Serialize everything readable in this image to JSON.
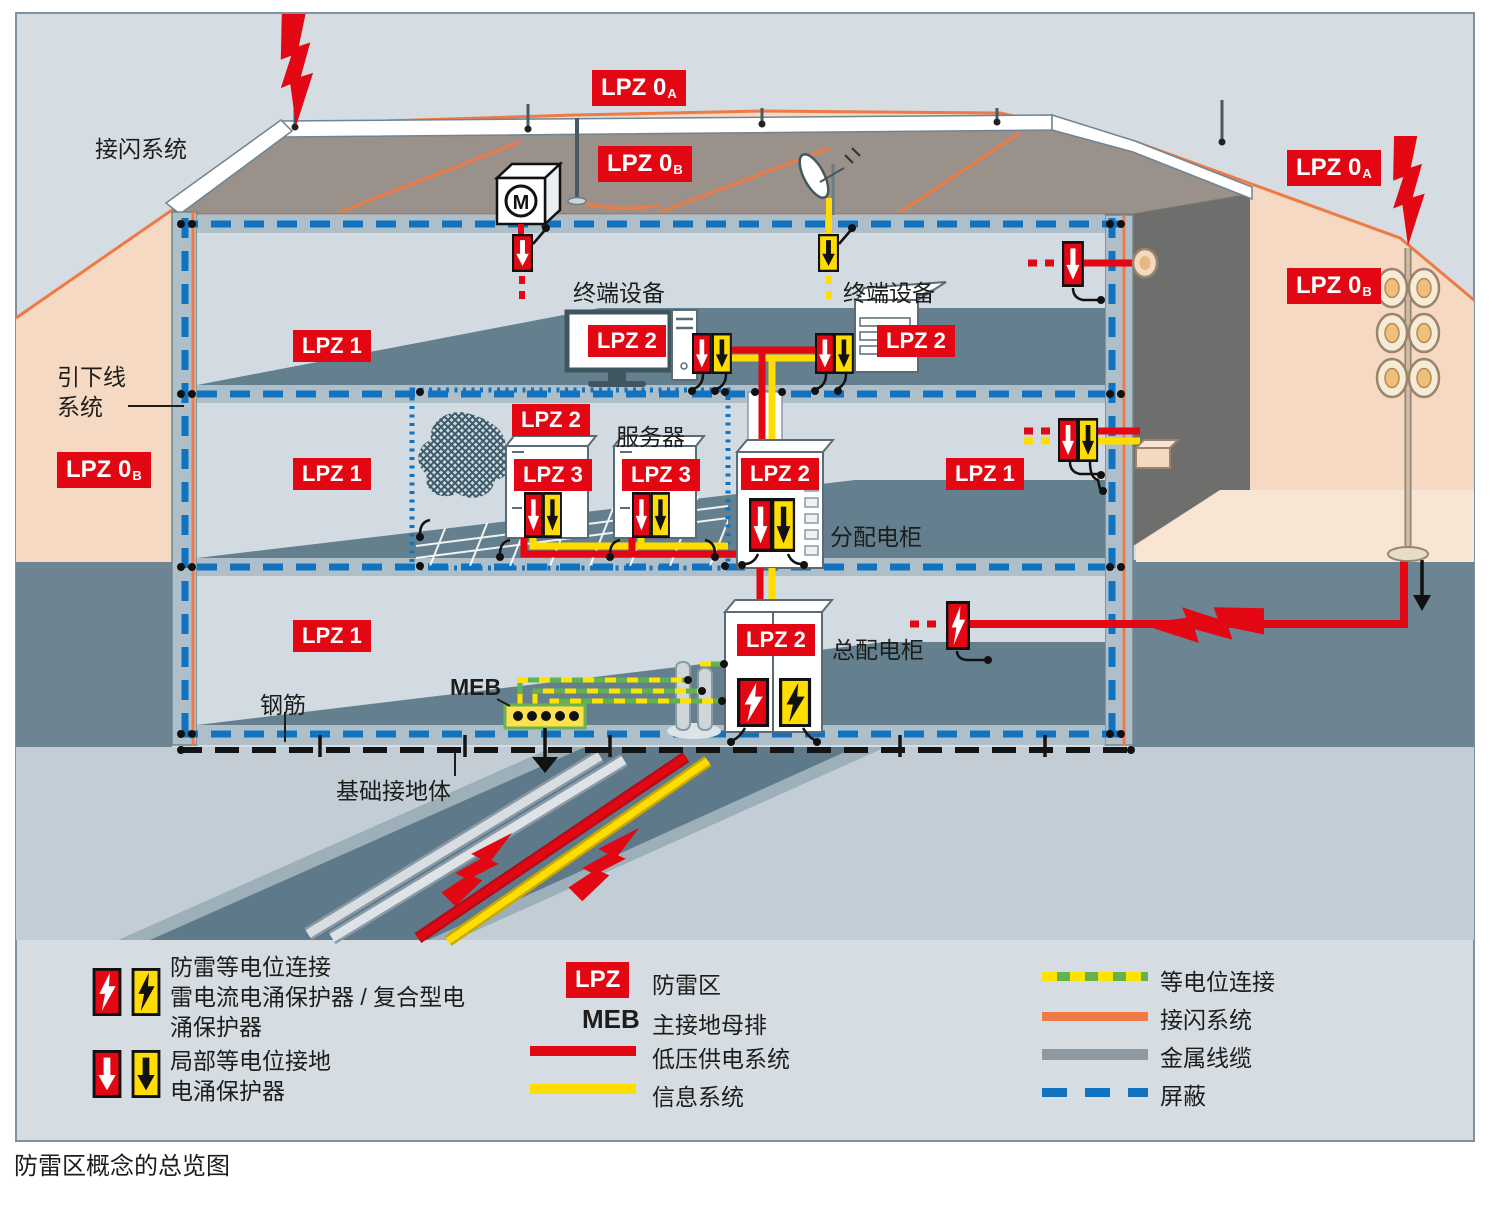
{
  "colors": {
    "lpz_red": "#e30613",
    "spd_yellow": "#ffdd00",
    "shield_blue": "#1173bf",
    "air_term_orange": "#ee7a45",
    "equipotential_green": "#63b24f",
    "zone_pink": "#f5d9c3",
    "ground_slate": "#6d8593",
    "panel_bg": "#d5dce2"
  },
  "badges": {
    "lpz0a_top": {
      "text": "LPZ 0",
      "sub": "A"
    },
    "lpz0b_roof": {
      "text": "LPZ 0",
      "sub": "B"
    },
    "lpz0a_right": {
      "text": "LPZ 0",
      "sub": "A"
    },
    "lpz0b_right": {
      "text": "LPZ 0",
      "sub": "B"
    },
    "lpz0b_left": {
      "text": "LPZ 0",
      "sub": "B"
    },
    "lpz1_floor1": {
      "text": "LPZ 1",
      "sub": ""
    },
    "lpz2_monitor": {
      "text": "LPZ 2",
      "sub": ""
    },
    "lpz2_copier": {
      "text": "LPZ 2",
      "sub": ""
    },
    "lpz1_floor2": {
      "text": "LPZ 1",
      "sub": ""
    },
    "lpz2_server_room": {
      "text": "LPZ 2",
      "sub": ""
    },
    "lpz3_server1": {
      "text": "LPZ 3",
      "sub": ""
    },
    "lpz3_server2": {
      "text": "LPZ 3",
      "sub": ""
    },
    "lpz2_dist": {
      "text": "LPZ 2",
      "sub": ""
    },
    "lpz1_floor2_right": {
      "text": "LPZ 1",
      "sub": ""
    },
    "lpz1_ground": {
      "text": "LPZ 1",
      "sub": ""
    },
    "lpz2_main": {
      "text": "LPZ 2",
      "sub": ""
    }
  },
  "labels": {
    "air_termination": "接闪系统",
    "down_conductor_1": "引下线",
    "down_conductor_2": "系统",
    "terminal_left": "终端设备",
    "terminal_right": "终端设备",
    "server": "服务器",
    "distribution_cabinet": "分配电柜",
    "main_cabinet": "总配电柜",
    "rebar": "钢筋",
    "meb": "MEB",
    "foundation_earth": "基础接地体",
    "motor": "M"
  },
  "legend": {
    "combo_lines": [
      "防雷等电位连接",
      "雷电流电涌保护器 / 复合型电",
      "涌保护器"
    ],
    "local_lines": [
      "局部等电位接地",
      "电涌保护器"
    ],
    "lpz_badge": "LPZ",
    "lpz_label": "防雷区",
    "meb_abbr": "MEB",
    "meb_label": "主接地母排",
    "power_label": "低压供电系统",
    "info_label": "信息系统",
    "equipotential_label": "等电位连接",
    "air_termination_label": "接闪系统",
    "metal_label": "金属线缆",
    "shield_label": "屏蔽"
  },
  "caption": "防雷区概念的总览图"
}
